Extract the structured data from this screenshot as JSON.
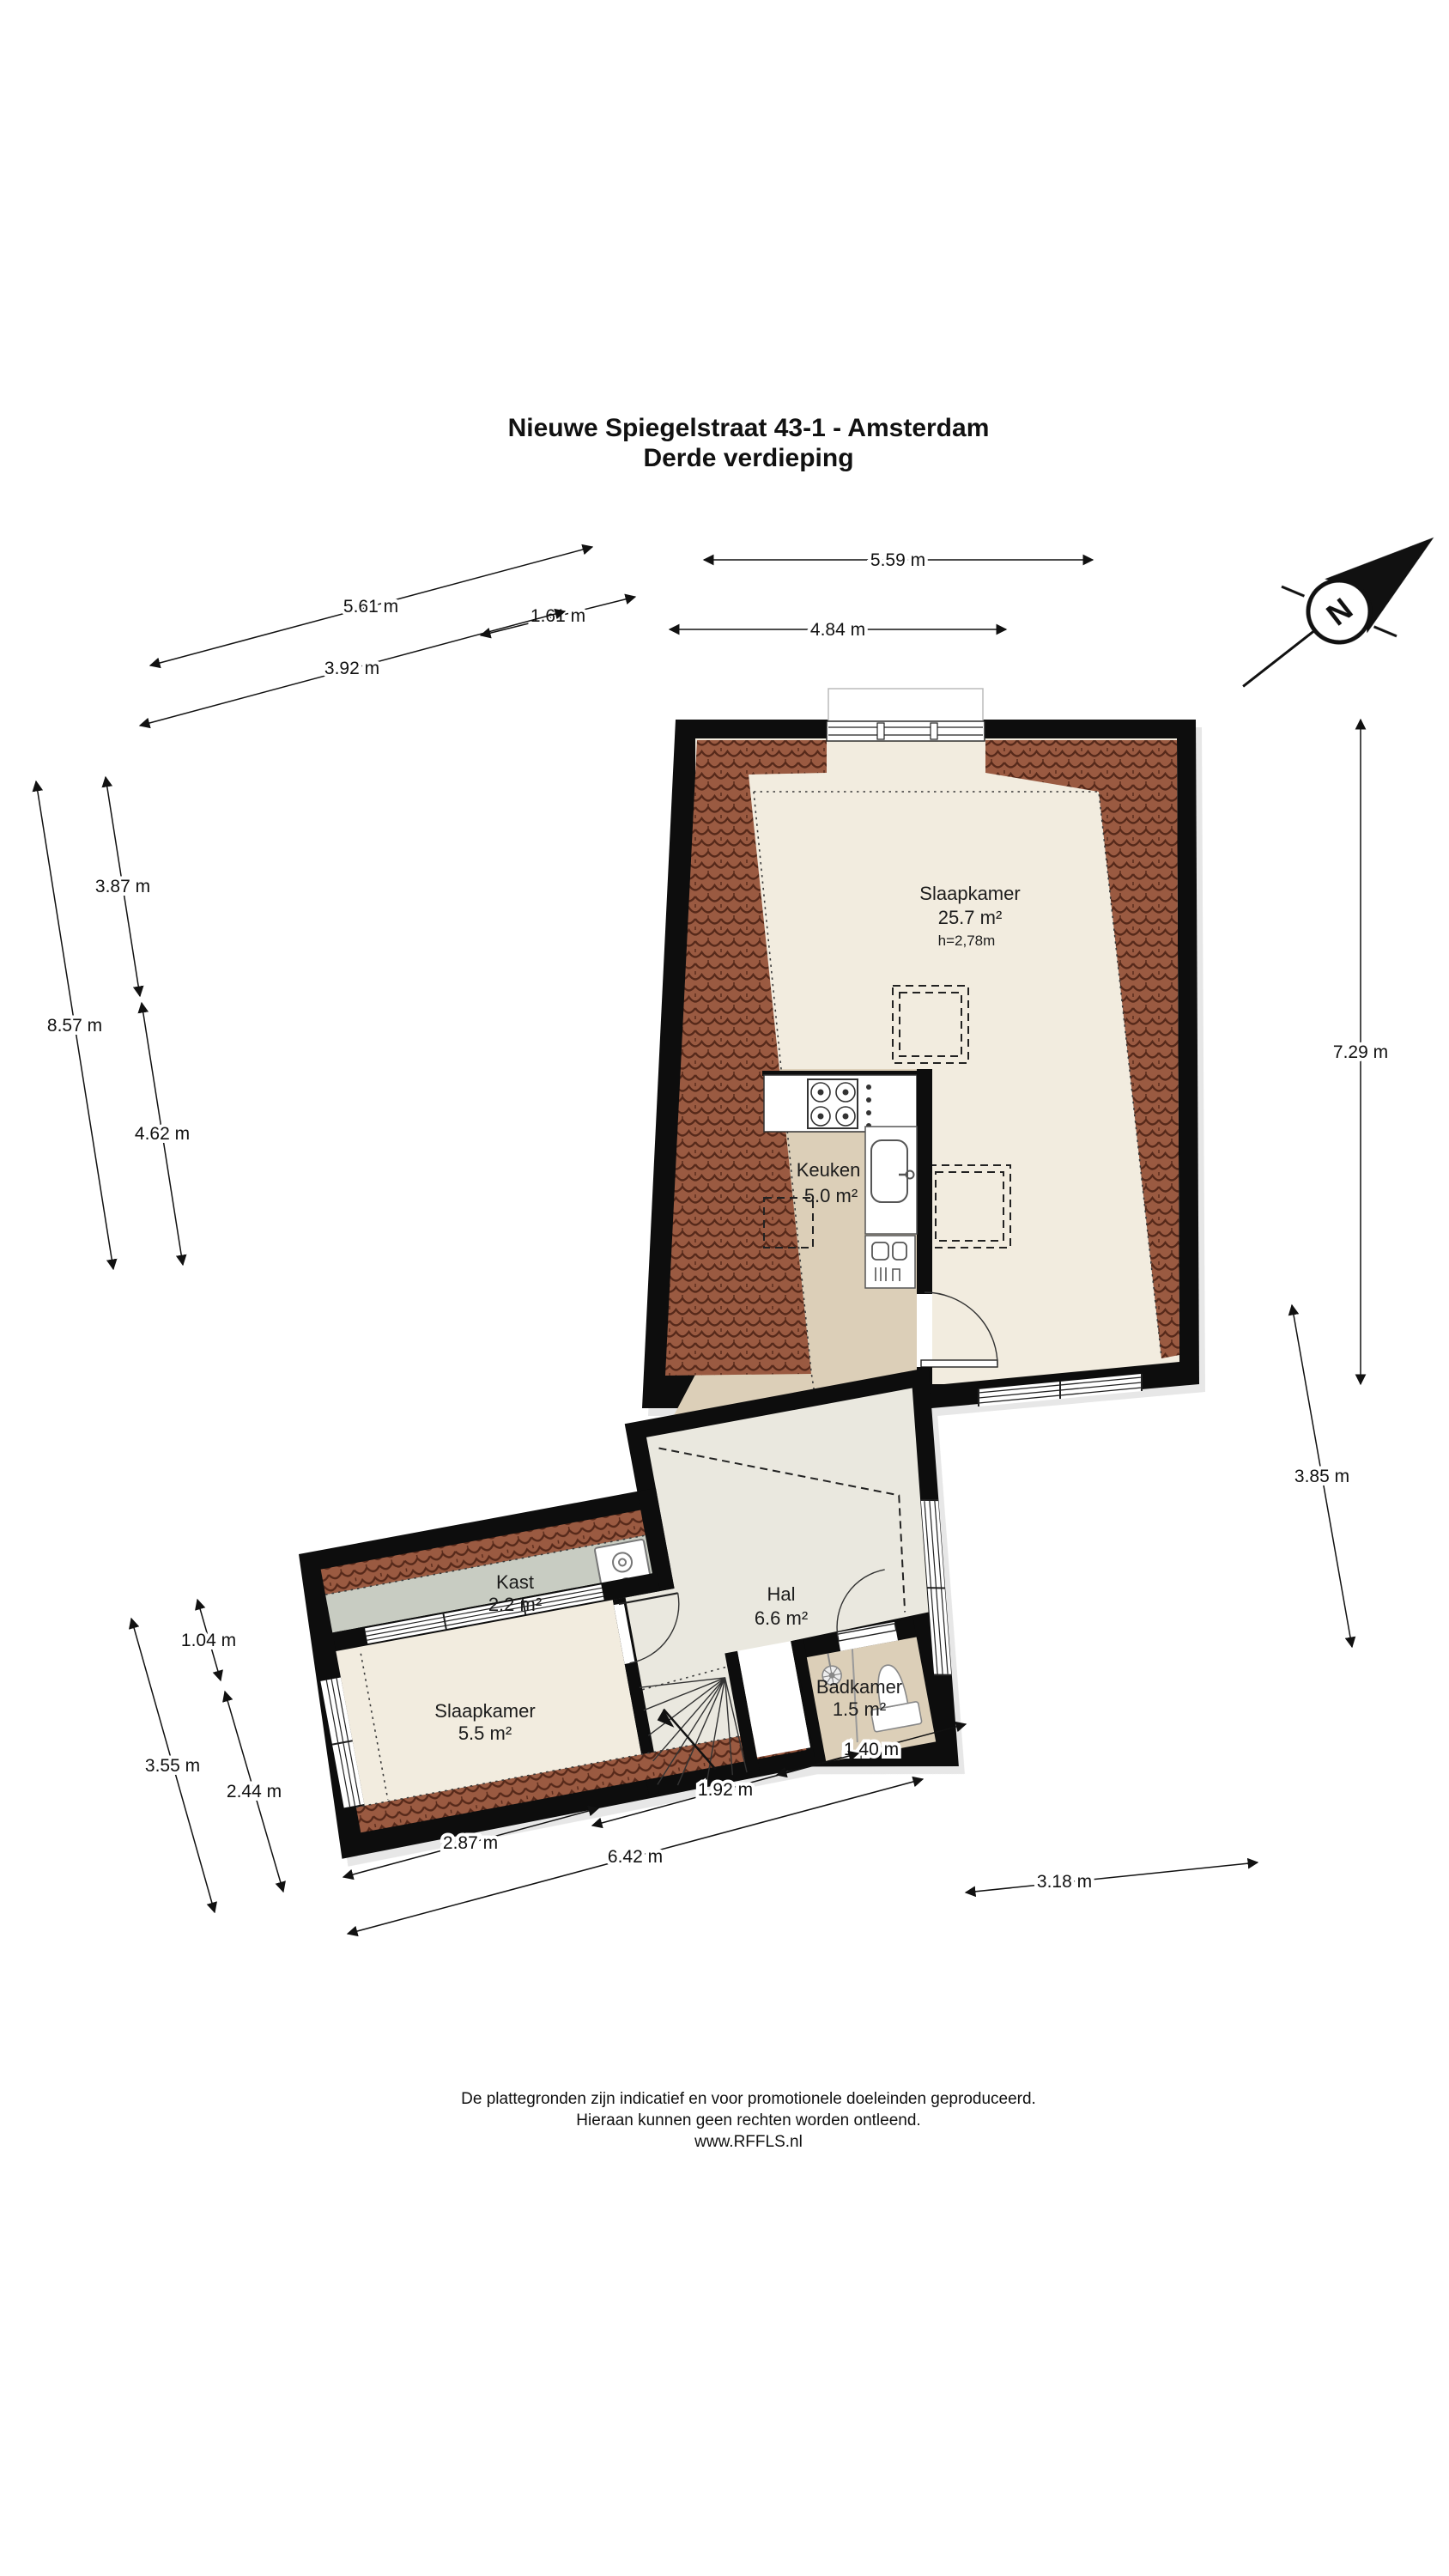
{
  "title": {
    "line1": "Nieuwe Spiegelstraat 43-1 - Amsterdam",
    "line2": "Derde verdieping"
  },
  "compass": {
    "label": "N"
  },
  "rooms": {
    "slaapkamer_main": {
      "name": "Slaapkamer",
      "area": "25.7 m²",
      "height": "h=2,78m"
    },
    "keuken": {
      "name": "Keuken",
      "area": "5.0 m²"
    },
    "kast": {
      "name": "Kast",
      "area": "2.2 m²"
    },
    "slaapkamer_klein": {
      "name": "Slaapkamer",
      "area": "5.5 m²"
    },
    "hal": {
      "name": "Hal",
      "area": "6.6 m²"
    },
    "badkamer": {
      "name": "Badkamer",
      "area": "1.5 m²"
    }
  },
  "dimensions": {
    "d561": "5.61 m",
    "d161": "1.61 m",
    "d392": "3.92 m",
    "d559": "5.59 m",
    "d484": "4.84 m",
    "d387": "3.87 m",
    "d857": "8.57 m",
    "d462": "4.62 m",
    "d104": "1.04 m",
    "d355": "3.55 m",
    "d244": "2.44 m",
    "d729": "7.29 m",
    "d385": "3.85 m",
    "d140": "1.40 m",
    "d192": "1.92 m",
    "d287": "2.87 m",
    "d642": "6.42 m",
    "d318": "3.18 m"
  },
  "footer": {
    "line1": "De plattegronden zijn indicatief en voor promotionele doeleinden geproduceerd.",
    "line2": "Hieraan kunnen geen rechten worden ontleend.",
    "line3": "www.RFFLS.nl"
  },
  "colors": {
    "wall": "#0d0d0d",
    "tile_base": "#9a5a41",
    "tile_line": "#56291a",
    "floor_cream": "#f2ecdf",
    "floor_tan": "#dccfb8",
    "floor_gray": "#c8ccc2",
    "floor_hal": "#eae8df"
  }
}
